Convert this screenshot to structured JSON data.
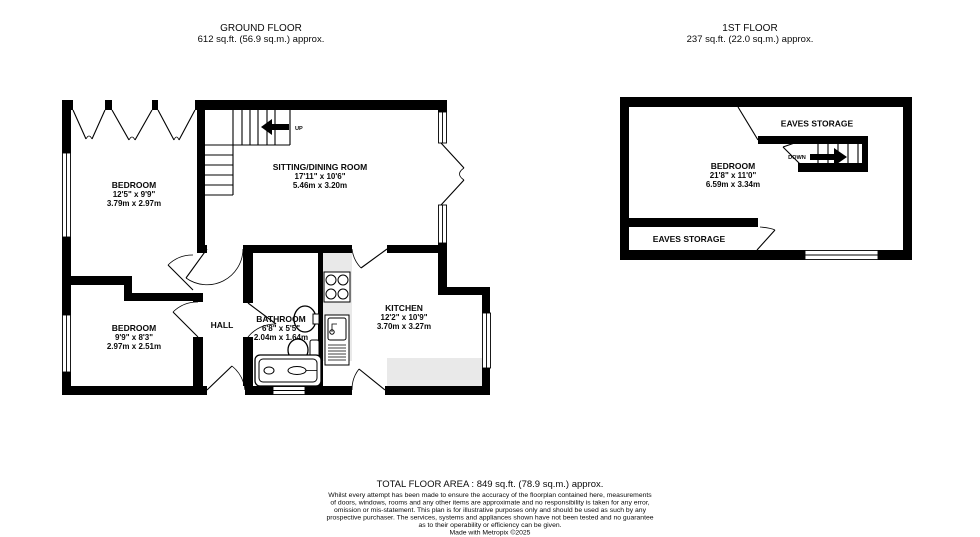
{
  "ground_floor": {
    "title": "GROUND FLOOR",
    "area": "612 sq.ft. (56.9 sq.m.) approx.",
    "stairs_label": "UP",
    "rooms": {
      "bedroom1": {
        "name": "BEDROOM",
        "imperial": "12'5\" x 9'9\"",
        "metric": "3.79m x 2.97m"
      },
      "sitting": {
        "name": "SITTING/DINING ROOM",
        "imperial": "17'11\" x 10'6\"",
        "metric": "5.46m x 3.20m"
      },
      "bedroom2": {
        "name": "BEDROOM",
        "imperial": "9'9\" x 8'3\"",
        "metric": "2.97m x 2.51m"
      },
      "hall": {
        "name": "HALL"
      },
      "bathroom": {
        "name": "BATHROOM",
        "imperial": "6'8\" x 5'5\"",
        "metric": "2.04m x 1.64m"
      },
      "kitchen": {
        "name": "KITCHEN",
        "imperial": "12'2\" x 10'9\"",
        "metric": "3.70m x 3.27m"
      }
    }
  },
  "first_floor": {
    "title": "1ST FLOOR",
    "area": "237 sq.ft. (22.0 sq.m.) approx.",
    "stairs_label": "DOWN",
    "rooms": {
      "bedroom": {
        "name": "BEDROOM",
        "imperial": "21'8\" x 11'0\"",
        "metric": "6.59m x 3.34m"
      },
      "eaves_top": {
        "name": "EAVES STORAGE"
      },
      "eaves_bottom": {
        "name": "EAVES STORAGE"
      }
    }
  },
  "footer": {
    "total_area": "TOTAL FLOOR AREA : 849 sq.ft. (78.9 sq.m.) approx.",
    "disclaimer_lines": [
      "Whilst every attempt has been made to ensure the accuracy of the floorplan contained here, measurements",
      "of doors, windows, rooms and any other items are approximate and no responsibility is taken for any error,",
      "omission or mis-statement. This plan is for illustrative purposes only and should be used as such by any",
      "prospective purchaser. The services, systems and appliances shown have not been tested and no guarantee",
      "as to their operability or efficiency can be given."
    ],
    "credit": "Made with Metropix ©2025"
  },
  "colors": {
    "wall": "#000000",
    "counter": "#e9e9e9",
    "background": "#ffffff",
    "text": "#0a0a0a"
  }
}
